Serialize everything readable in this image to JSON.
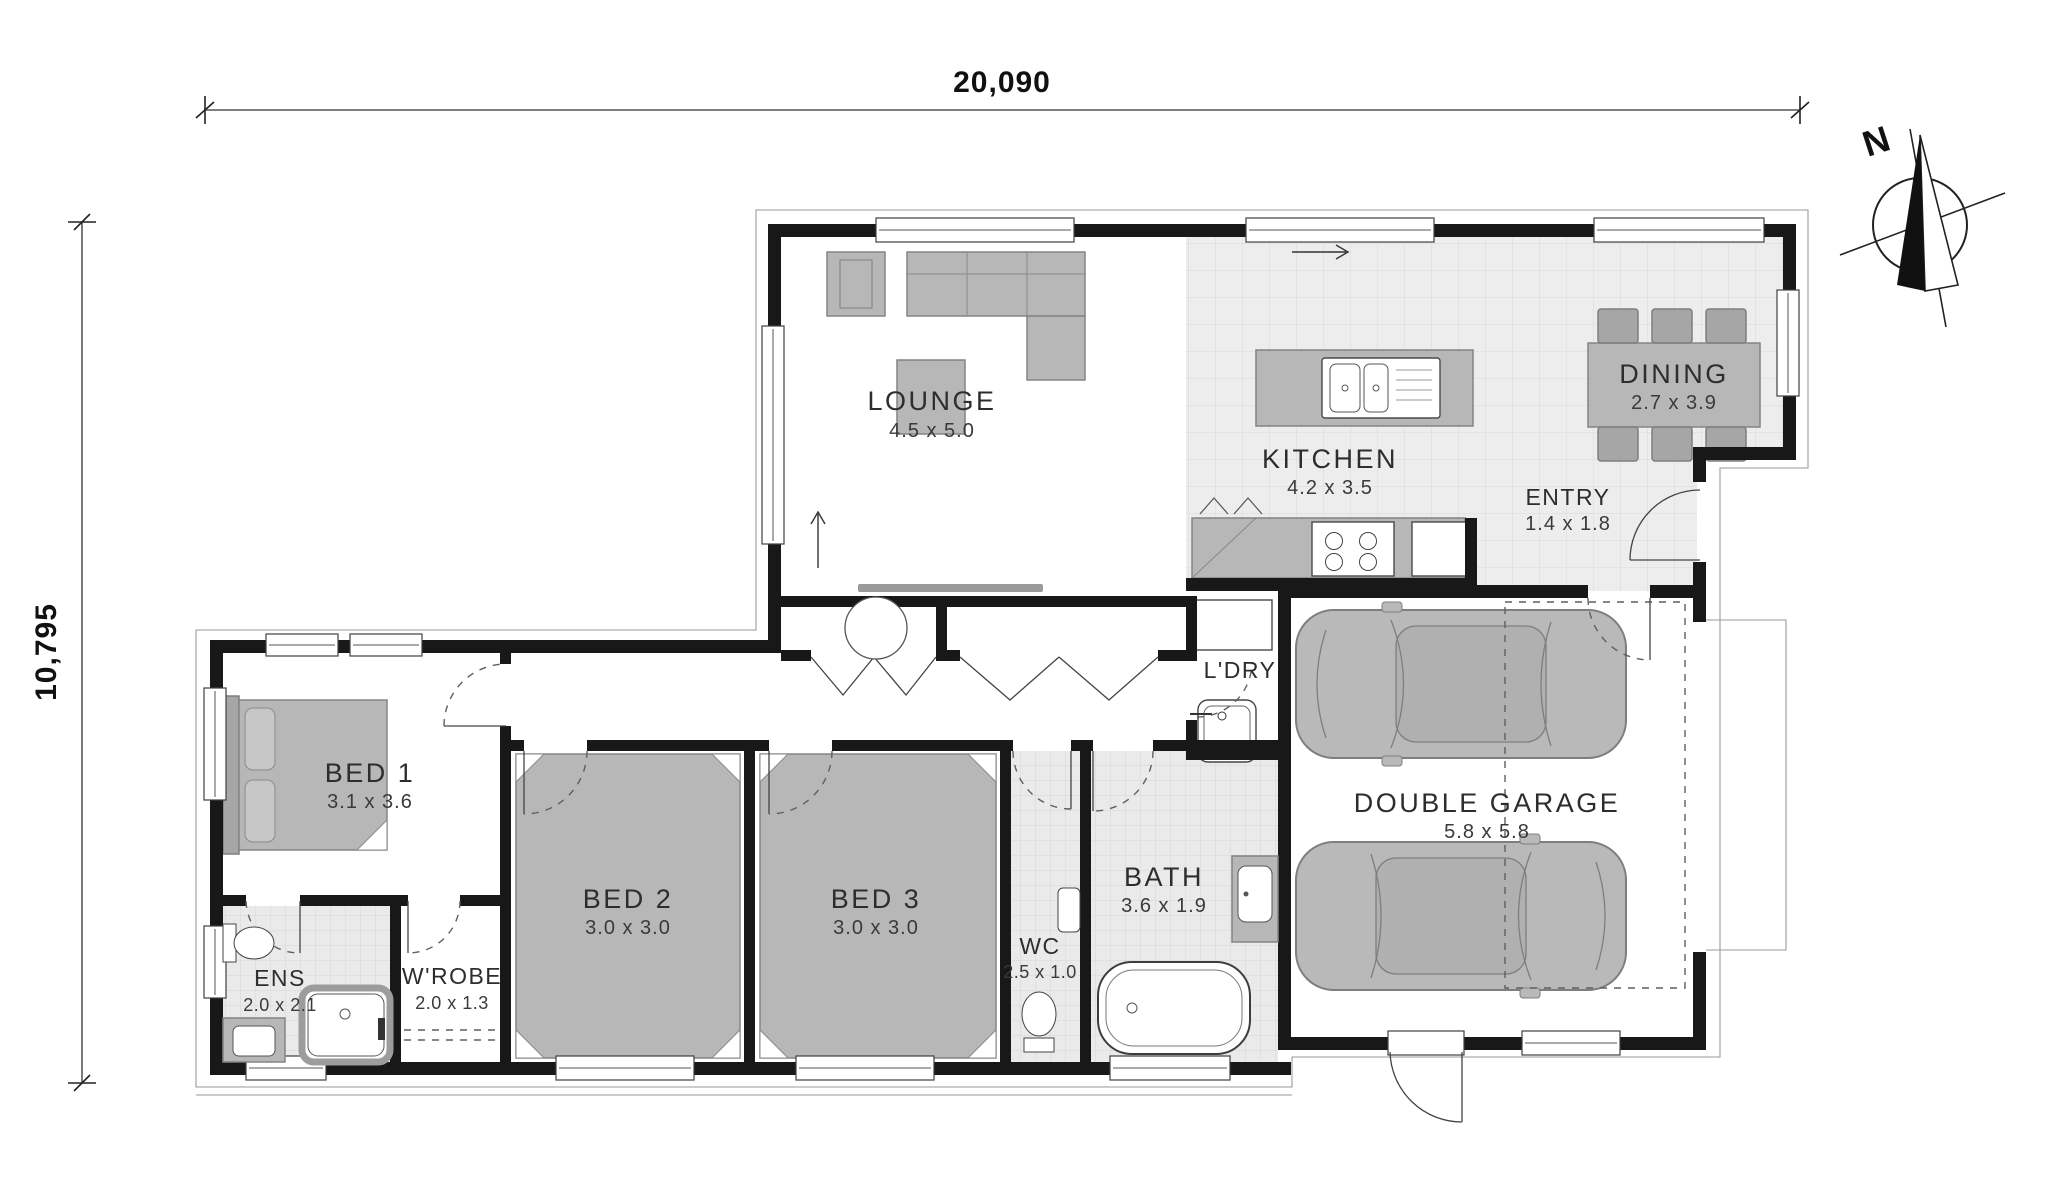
{
  "drawing": {
    "type": "floor-plan",
    "overall_width": "20,090",
    "overall_depth": "10,795",
    "north_label": "N"
  },
  "rooms": [
    {
      "name": "LOUNGE",
      "dims": "4.5 x 5.0"
    },
    {
      "name": "KITCHEN",
      "dims": "4.2 x 3.5"
    },
    {
      "name": "DINING",
      "dims": "2.7 x 3.9"
    },
    {
      "name": "ENTRY",
      "dims": "1.4 x 1.8"
    },
    {
      "name": "L'DRY",
      "dims": ""
    },
    {
      "name": "DOUBLE GARAGE",
      "dims": "5.8 x 5.8"
    },
    {
      "name": "BED 1",
      "dims": "3.1 x 3.6"
    },
    {
      "name": "BED 2",
      "dims": "3.0 x 3.0"
    },
    {
      "name": "BED 3",
      "dims": "3.0 x 3.0"
    },
    {
      "name": "ENS",
      "dims": "2.0 x 2.1"
    },
    {
      "name": "W'ROBE",
      "dims": "2.0 x 1.3"
    },
    {
      "name": "WC",
      "dims": "2.5 x 1.0"
    },
    {
      "name": "BATH",
      "dims": "3.6 x 1.9"
    }
  ],
  "colors": {
    "wall": "#181818",
    "furniture": "#b7b7b7",
    "tile": "#ededed",
    "paper": "#ffffff"
  }
}
